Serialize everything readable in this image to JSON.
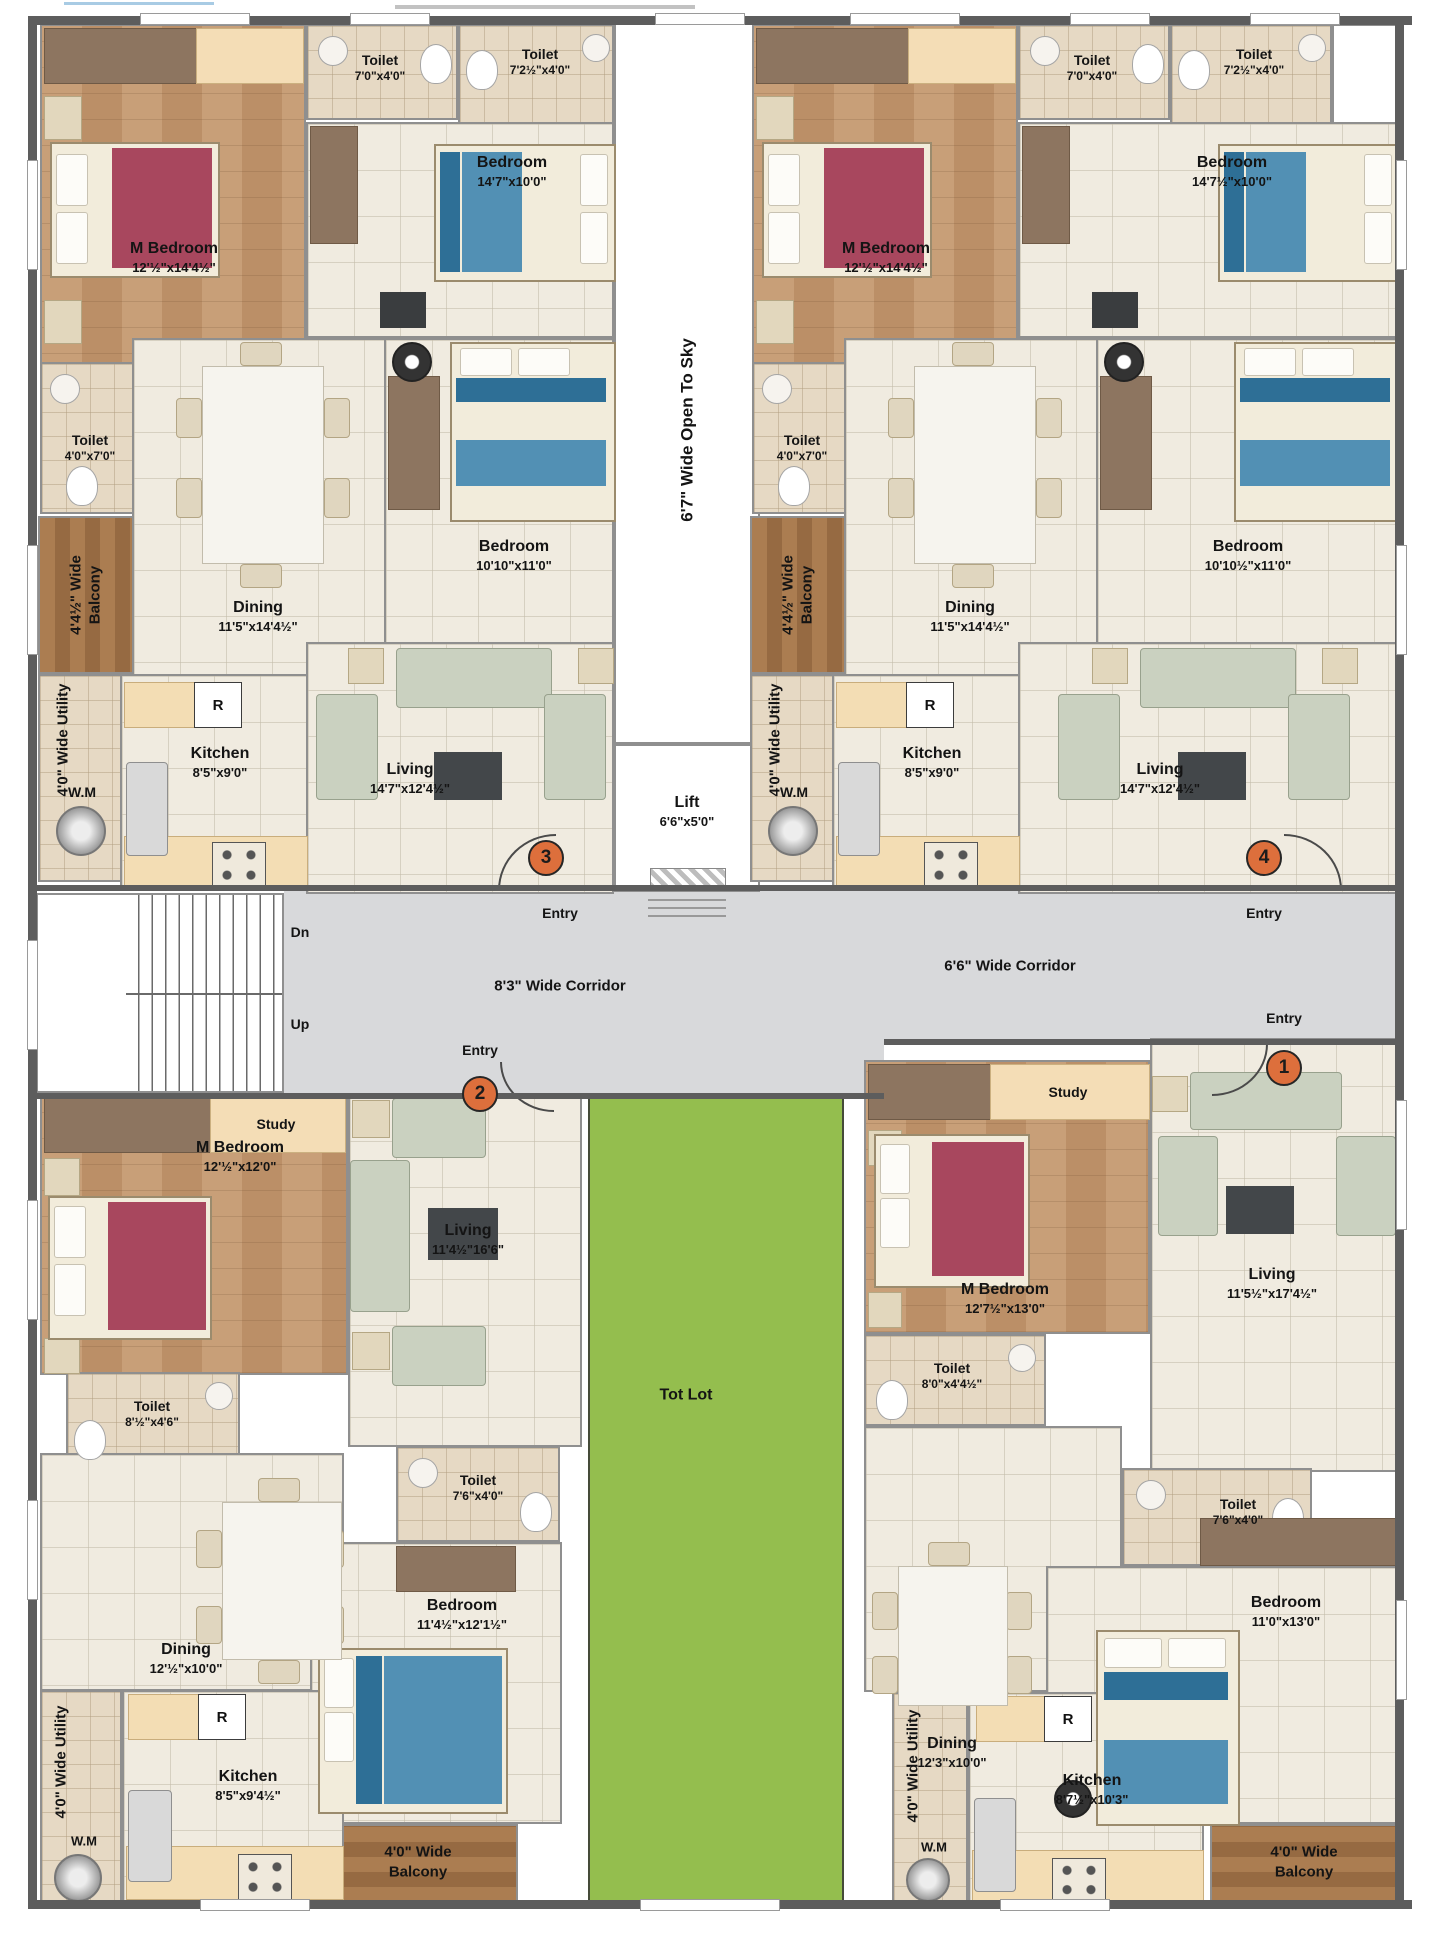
{
  "common": {
    "open_to_sky": "6'7\" Wide Open To Sky",
    "lift_name": "Lift",
    "lift_dim": "6'6\"x5'0\"",
    "corridor_left": "8'3\" Wide Corridor",
    "corridor_right": "6'6\" Wide Corridor",
    "dn": "Dn",
    "up": "Up",
    "tot_lot": "Tot Lot",
    "entry": "Entry",
    "wm": "W.M",
    "fridge": "R"
  },
  "flat3": {
    "number": "3",
    "m_bedroom": {
      "name": "M Bedroom",
      "dim": "12'½\"x14'4½\""
    },
    "toilet_top1": {
      "name": "Toilet",
      "dim": "7'0\"x4'0\""
    },
    "toilet_top2": {
      "name": "Toilet",
      "dim": "7'2½\"x4'0\""
    },
    "bedroom2": {
      "name": "Bedroom",
      "dim": "14'7\"x10'0\""
    },
    "bedroom3": {
      "name": "Bedroom",
      "dim": "10'10\"x11'0\""
    },
    "toilet_side": {
      "name": "Toilet",
      "dim": "4'0\"x7'0\""
    },
    "balcony_l1": "4'4½\" Wide",
    "balcony_l2": "Balcony",
    "dining": {
      "name": "Dining",
      "dim": "11'5\"x14'4½\""
    },
    "utility": "4'0\" Wide Utility",
    "kitchen": {
      "name": "Kitchen",
      "dim": "8'5\"x9'0\""
    },
    "living": {
      "name": "Living",
      "dim": "14'7\"x12'4½\""
    }
  },
  "flat4": {
    "number": "4",
    "m_bedroom": {
      "name": "M Bedroom",
      "dim": "12'½\"x14'4½\""
    },
    "toilet_top1": {
      "name": "Toilet",
      "dim": "7'0\"x4'0\""
    },
    "toilet_top2": {
      "name": "Toilet",
      "dim": "7'2½\"x4'0\""
    },
    "bedroom2": {
      "name": "Bedroom",
      "dim": "14'7½\"x10'0\""
    },
    "bedroom3": {
      "name": "Bedroom",
      "dim": "10'10½\"x11'0\""
    },
    "toilet_side": {
      "name": "Toilet",
      "dim": "4'0\"x7'0\""
    },
    "balcony_l1": "4'4½\" Wide",
    "balcony_l2": "Balcony",
    "dining": {
      "name": "Dining",
      "dim": "11'5\"x14'4½\""
    },
    "utility": "4'0\" Wide Utility",
    "kitchen": {
      "name": "Kitchen",
      "dim": "8'5\"x9'0\""
    },
    "living": {
      "name": "Living",
      "dim": "14'7\"x12'4½\""
    }
  },
  "flat2": {
    "number": "2",
    "study": "Study",
    "m_bedroom": {
      "name": "M Bedroom",
      "dim": "12'½\"x12'0\""
    },
    "living": {
      "name": "Living",
      "dim": "11'4½\"16'6\""
    },
    "toilet1": {
      "name": "Toilet",
      "dim": "8'½\"x4'6\""
    },
    "toilet2": {
      "name": "Toilet",
      "dim": "7'6\"x4'0\""
    },
    "dining": {
      "name": "Dining",
      "dim": "12'½\"x10'0\""
    },
    "kitchen": {
      "name": "Kitchen",
      "dim": "8'5\"x9'4½\""
    },
    "bedroom2": {
      "name": "Bedroom",
      "dim": "11'4½\"x12'1½\""
    },
    "balcony_l1": "4'0\" Wide",
    "balcony_l2": "Balcony",
    "utility": "4'0\" Wide Utility"
  },
  "flat1": {
    "number": "1",
    "study": "Study",
    "m_bedroom": {
      "name": "M Bedroom",
      "dim": "12'7½\"x13'0\""
    },
    "living": {
      "name": "Living",
      "dim": "11'5½\"x17'4½\""
    },
    "toilet1": {
      "name": "Toilet",
      "dim": "8'0\"x4'4½\""
    },
    "toilet2": {
      "name": "Toilet",
      "dim": "7'6\"x4'0\""
    },
    "dining": {
      "name": "Dining",
      "dim": "12'3\"x10'0\""
    },
    "kitchen": {
      "name": "Kitchen",
      "dim": "8'7½\"x10'3\""
    },
    "bedroom2": {
      "name": "Bedroom",
      "dim": "11'0\"x13'0\""
    },
    "balcony_l1": "4'0\" Wide",
    "balcony_l2": "Balcony",
    "utility": "4'0\" Wide Utility"
  },
  "colors": {
    "entry_marker": "#dd6f3c",
    "tot_lot_green": "#94be4e",
    "corridor_gray": "#d8d9db",
    "wood_floor": "#c49a73",
    "balcony_wood": "#a97c50"
  }
}
